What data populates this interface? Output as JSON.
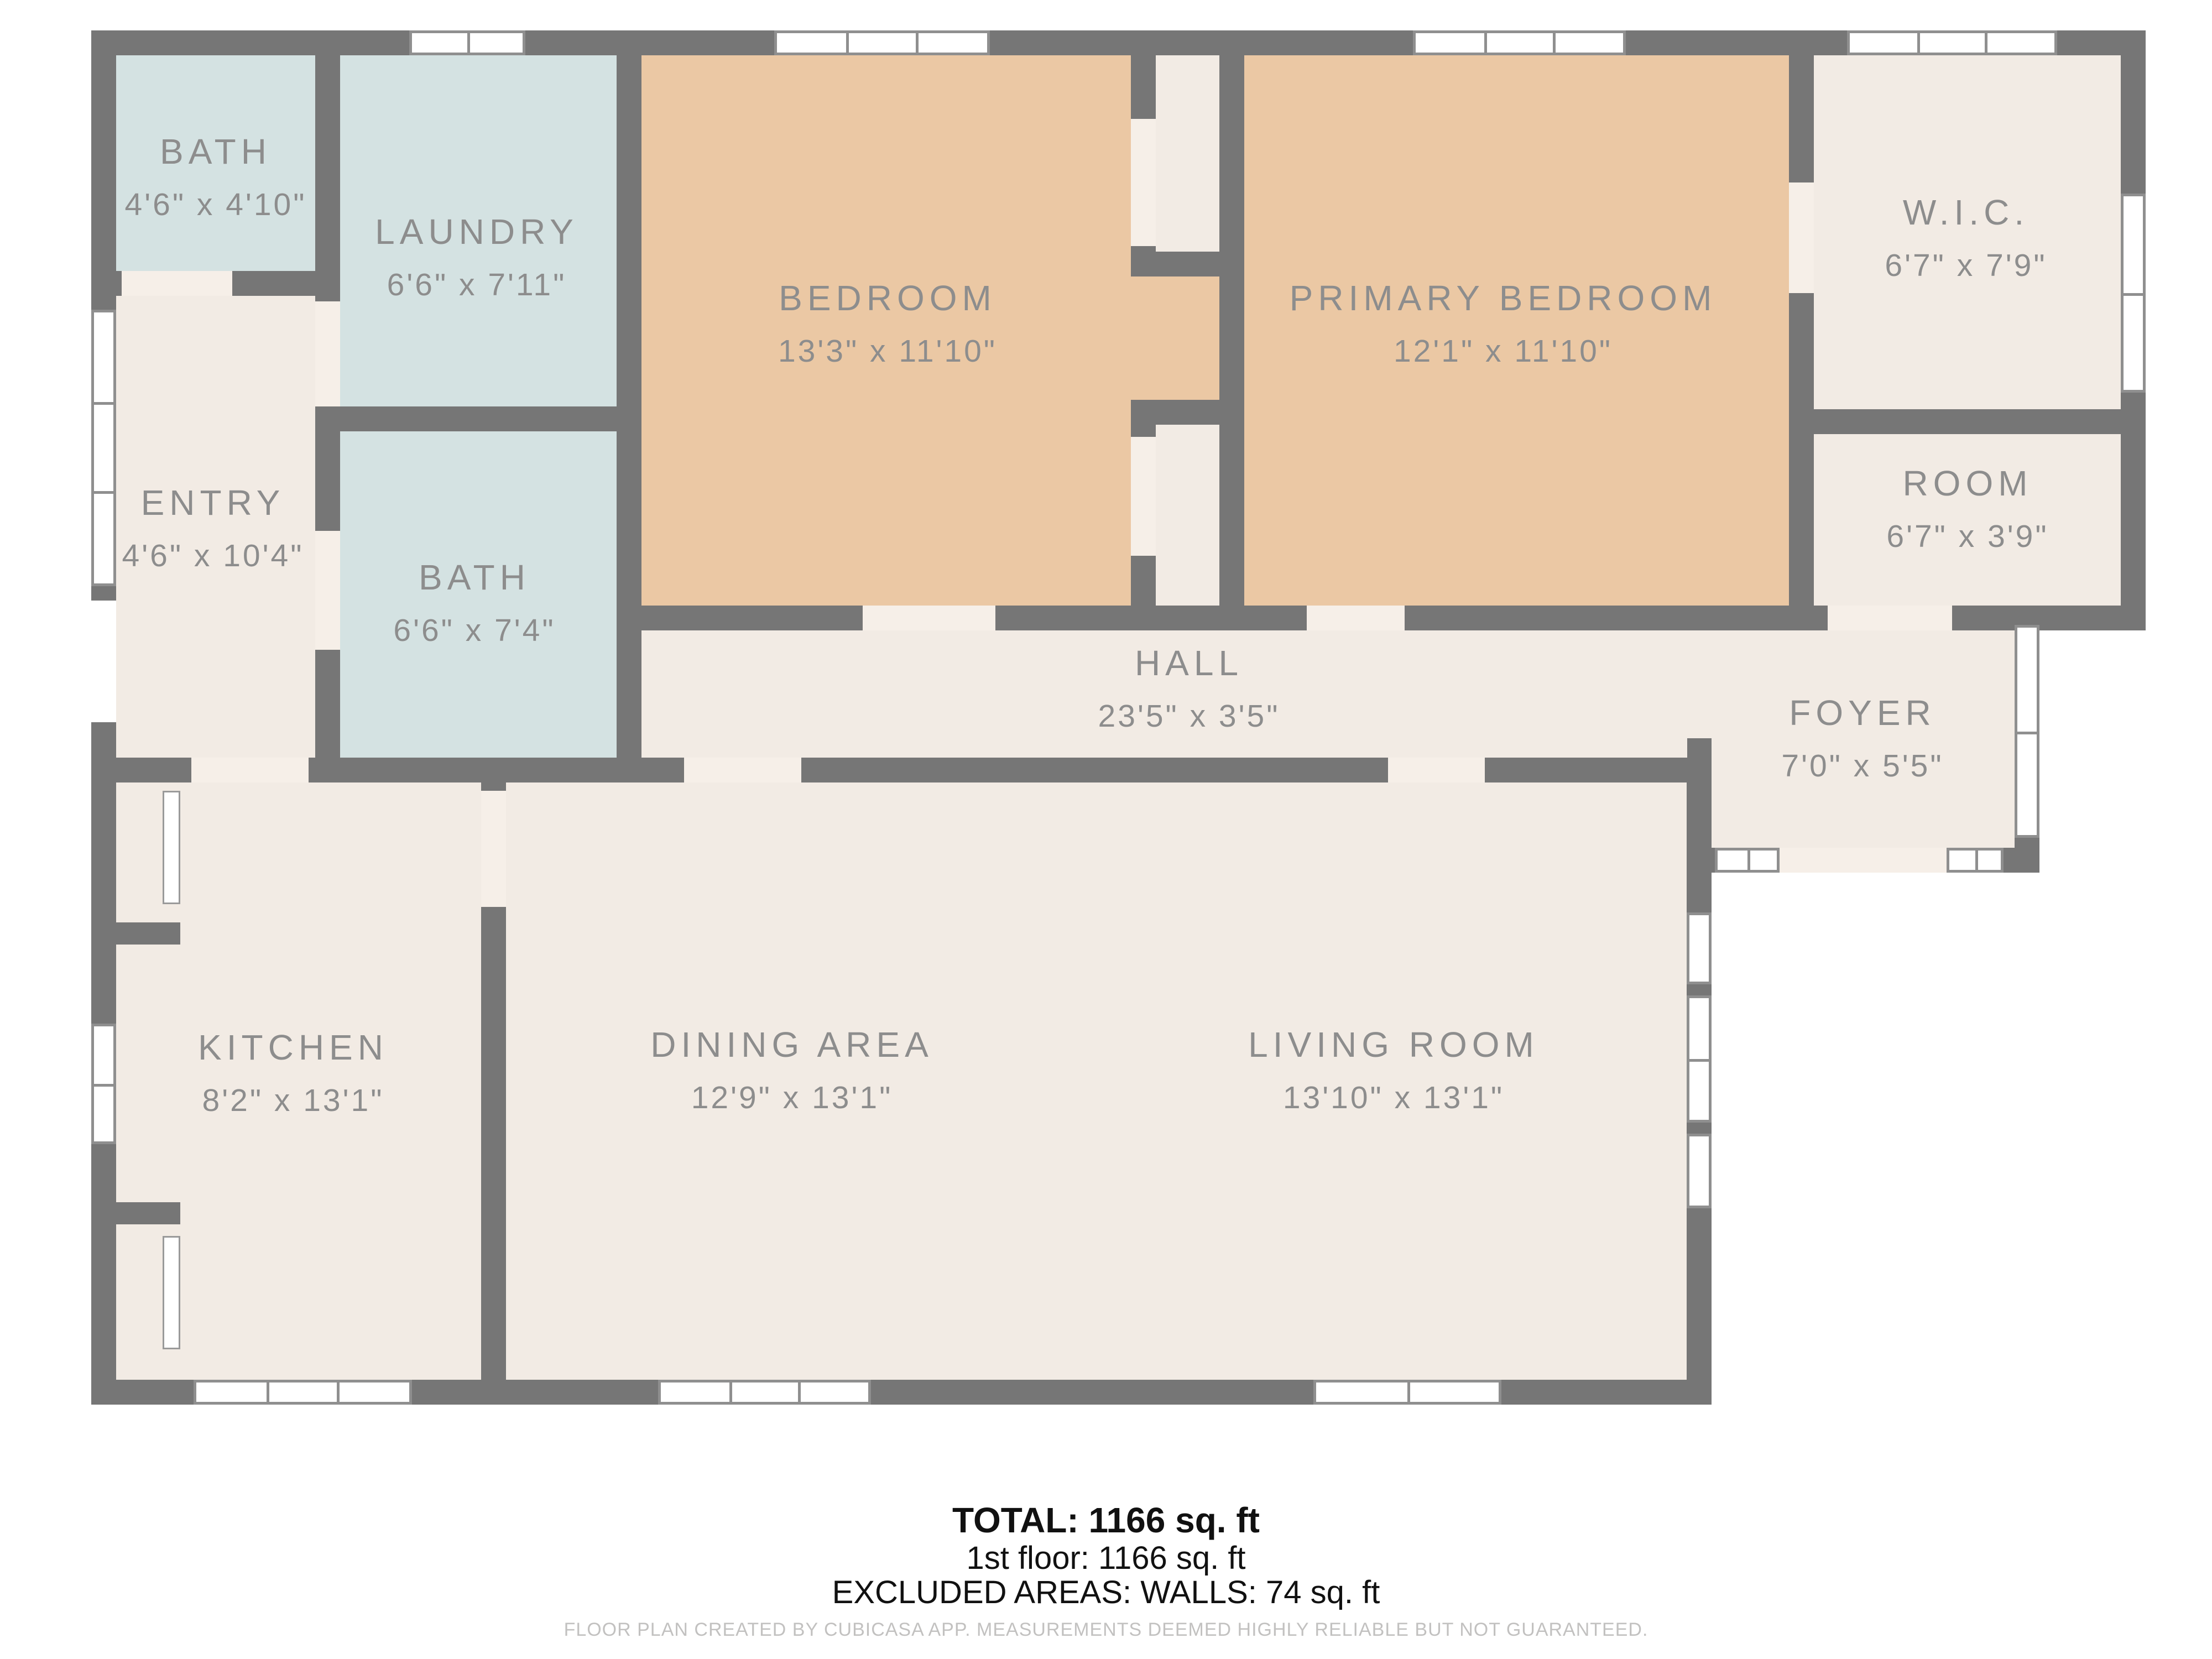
{
  "rooms": [
    {
      "name": "BATH",
      "dims": "4'6\" x 4'10\""
    },
    {
      "name": "LAUNDRY",
      "dims": "6'6\" x 7'11\""
    },
    {
      "name": "BEDROOM",
      "dims": "13'3\" x 11'10\""
    },
    {
      "name": "PRIMARY BEDROOM",
      "dims": "12'1\" x 11'10\""
    },
    {
      "name": "W.I.C.",
      "dims": "6'7\" x 7'9\""
    },
    {
      "name": "ENTRY",
      "dims": "4'6\" x 10'4\""
    },
    {
      "name": "BATH",
      "dims": "6'6\" x 7'4\""
    },
    {
      "name": "ROOM",
      "dims": "6'7\" x 3'9\""
    },
    {
      "name": "HALL",
      "dims": "23'5\" x 3'5\""
    },
    {
      "name": "FOYER",
      "dims": "7'0\" x 5'5\""
    },
    {
      "name": "KITCHEN",
      "dims": "8'2\" x 13'1\""
    },
    {
      "name": "DINING AREA",
      "dims": "12'9\" x 13'1\""
    },
    {
      "name": "LIVING ROOM",
      "dims": "13'10\" x 13'1\""
    }
  ],
  "totals": {
    "total": "TOTAL: 1166 sq. ft",
    "floor1": "1st floor: 1166 sq. ft",
    "excluded": "EXCLUDED AREAS: WALLS: 74 sq. ft"
  },
  "credit": "FLOOR PLAN CREATED BY CUBICASA APP. MEASUREMENTS DEEMED HIGHLY RELIABLE BUT NOT GUARANTEED.",
  "colors": {
    "wall": "#767676",
    "floor": "#f2ebe4",
    "bedroom_fill": "#ebc8a4",
    "bath_laundry_fill": "#d4e2e2",
    "label_text": "#8d8d8d",
    "total_text": "#111111",
    "credit_text": "#c2c1c0"
  }
}
